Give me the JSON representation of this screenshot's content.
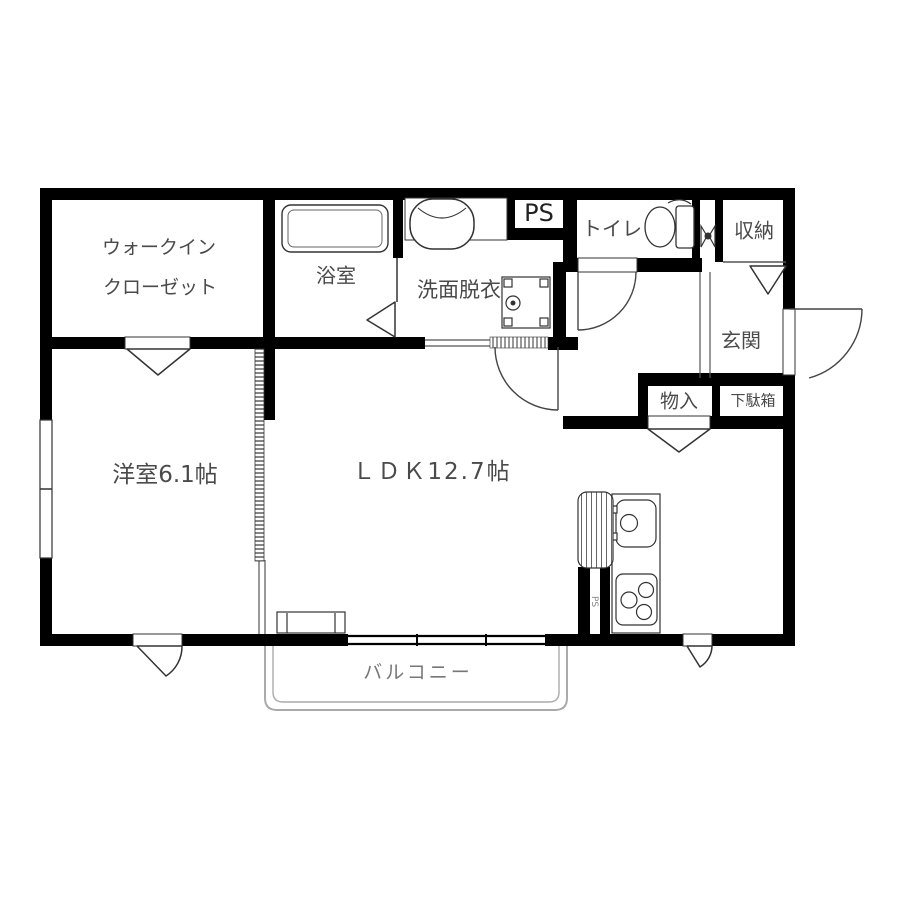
{
  "plan": {
    "title": "2LDK apartment floor plan",
    "labels": {
      "wic_line1": "ウォークイン",
      "wic_line2": "クローゼット",
      "bath": "浴室",
      "washroom": "洗面脱衣",
      "ps": "PS",
      "ps_kitchen": "PS",
      "toilet": "トイレ",
      "storage": "収納",
      "entrance": "玄関",
      "closet": "物入",
      "shoe_cabinet": "下駄箱",
      "western_room": "洋室6.1帖",
      "ldk": "ＬＤＫ12.7帖",
      "balcony": "バルコニー"
    },
    "colors": {
      "wall": "#000000",
      "thin_line": "#444444",
      "label_text": "#4a4a4a",
      "balcony_line": "#aaaaaa"
    }
  }
}
